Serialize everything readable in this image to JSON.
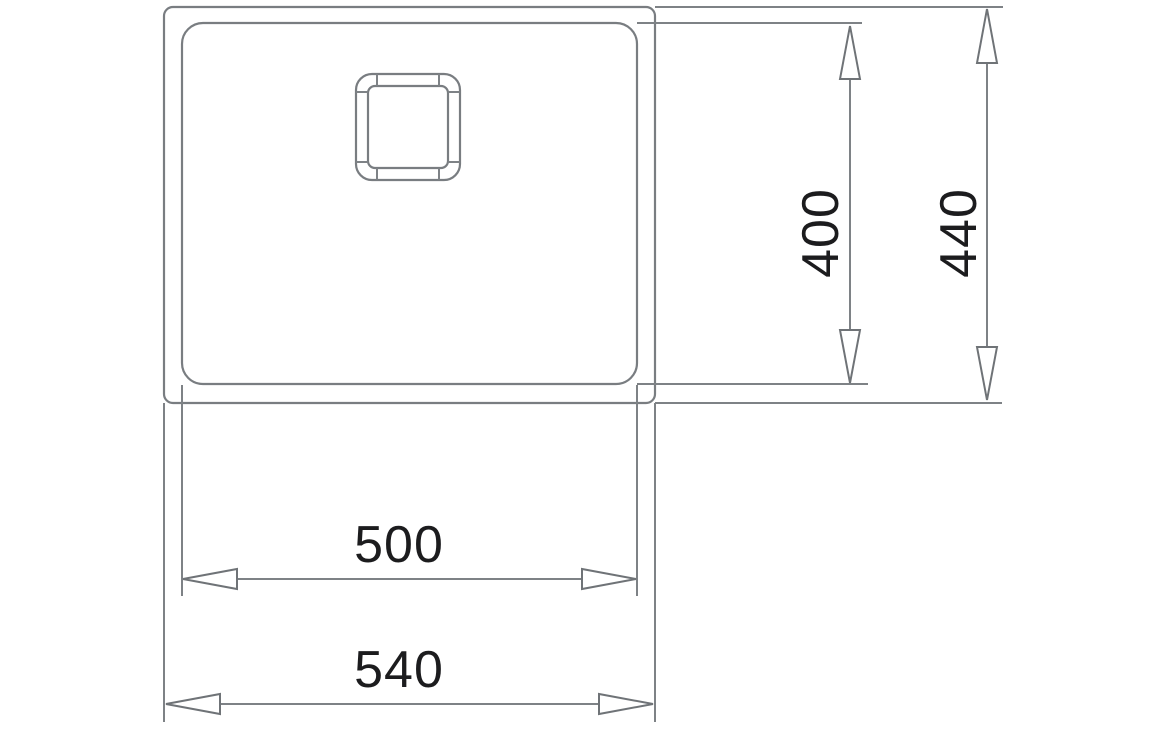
{
  "drawing": {
    "kind": "sink-dimension-diagram",
    "dimension_labels": {
      "inner_width": "500",
      "outer_width": "540",
      "inner_height": "400",
      "outer_height": "440"
    },
    "colors": {
      "line_gray": "#797d81",
      "arrow_gray": "#6f7377",
      "text_black": "#1c1c1e",
      "background": "#ffffff"
    }
  }
}
